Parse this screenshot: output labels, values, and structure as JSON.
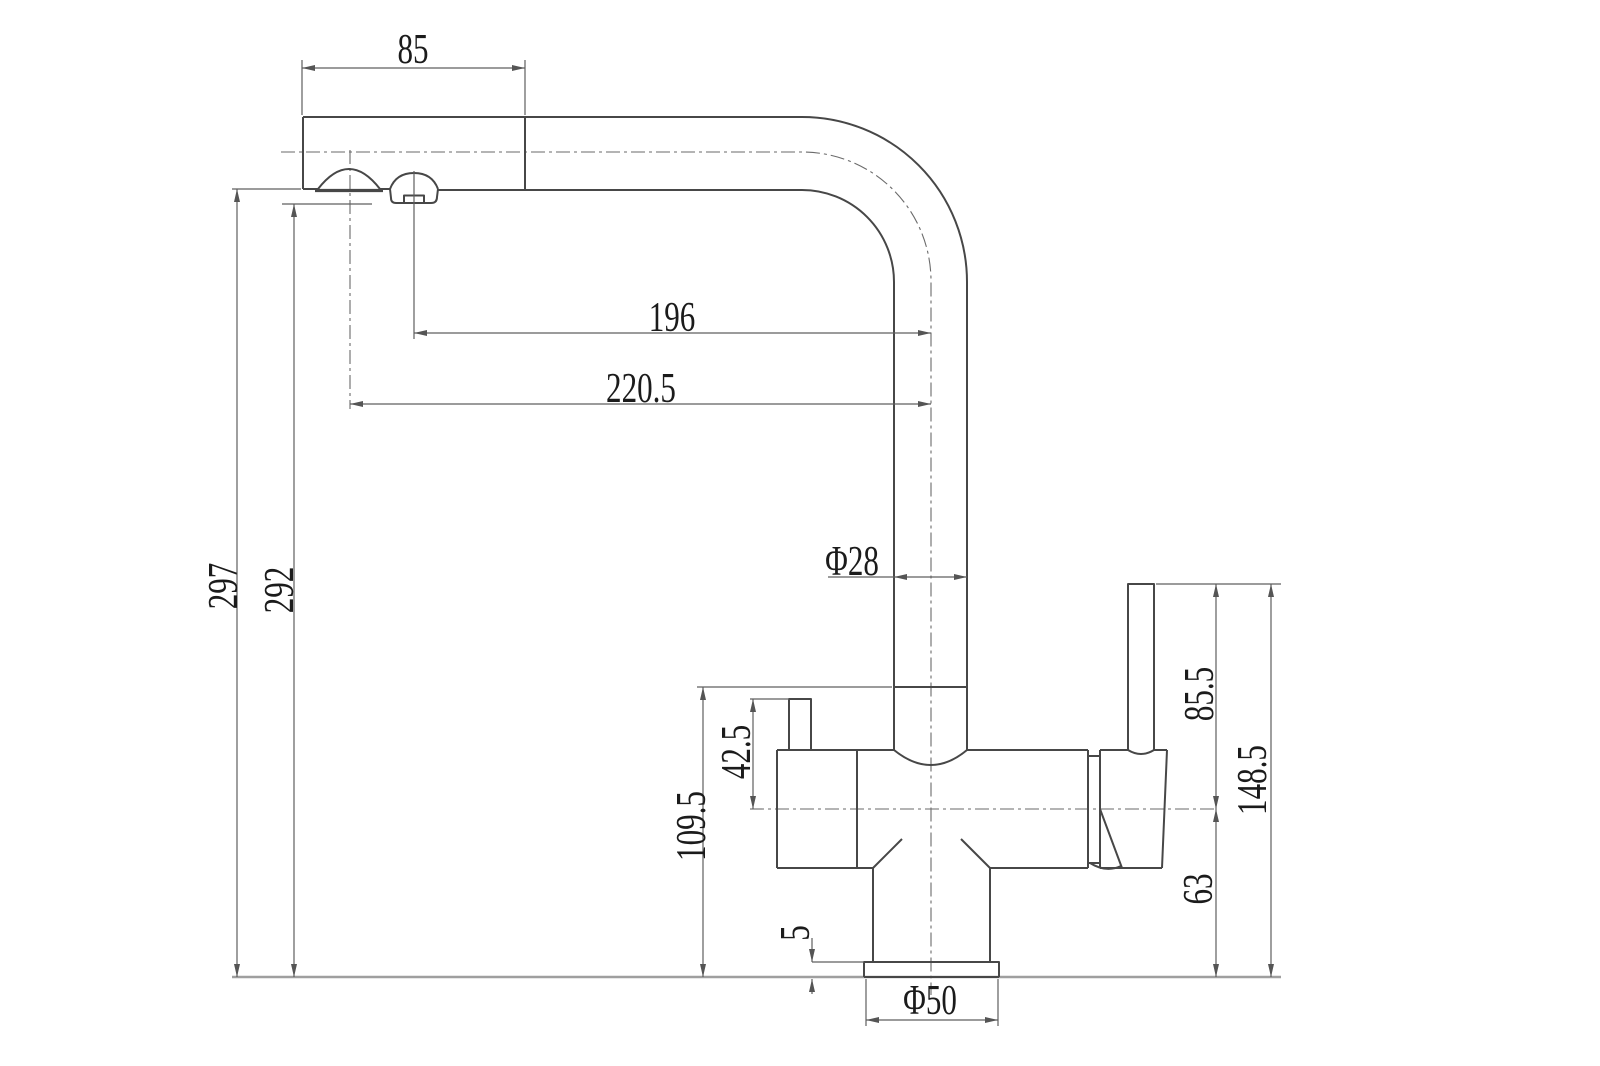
{
  "dims": {
    "spout_end_length": "85",
    "reach_to_aerator": "196",
    "reach_to_tip": "220.5",
    "height_to_spout_tip": "297",
    "height_to_aerator": "292",
    "spout_tube_diameter": "Φ28",
    "knob_top_to_axis": "42.5",
    "pipe_base_to_counter": "109.5",
    "lever_top_to_axis": "85.5",
    "lever_top_to_counter": "148.5",
    "axis_to_counter": "63",
    "base_plate_thickness": "5",
    "base_diameter": "Φ50"
  },
  "colors": {
    "outline": "#474747",
    "dimension": "#5f5f5f",
    "text": "#1b1b1b",
    "countertop": "#9f9f9f",
    "background": "#ffffff"
  }
}
